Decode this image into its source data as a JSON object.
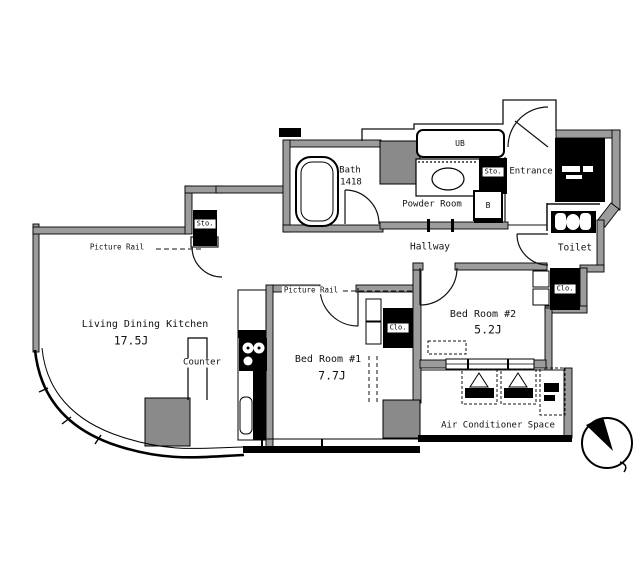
{
  "rooms": {
    "ldk": {
      "name": "Living Dining Kitchen",
      "size": "17.5J"
    },
    "bedroom1": {
      "name": "Bed Room #1",
      "size": "7.7J"
    },
    "bedroom2": {
      "name": "Bed Room #2",
      "size": "5.2J"
    },
    "bath": {
      "name": "Bath",
      "size": "1418"
    },
    "powder_room": {
      "name": "Powder Room"
    },
    "hallway": {
      "name": "Hallway"
    },
    "entrance": {
      "name": "Entrance"
    },
    "toilet": {
      "name": "Toilet"
    },
    "ac_space": {
      "name": "Air Conditioner Space"
    }
  },
  "labels": {
    "counter": "Counter",
    "picture_rail": "Picture Rail",
    "unit_bath": "UB",
    "b_box": "B",
    "storage": "Sto.",
    "closet": "Clo."
  },
  "colors": {
    "wall": "#9c9c9c",
    "line": "#111111",
    "pillar": "#8a8a8a",
    "black": "#000000",
    "background": "#ffffff"
  }
}
